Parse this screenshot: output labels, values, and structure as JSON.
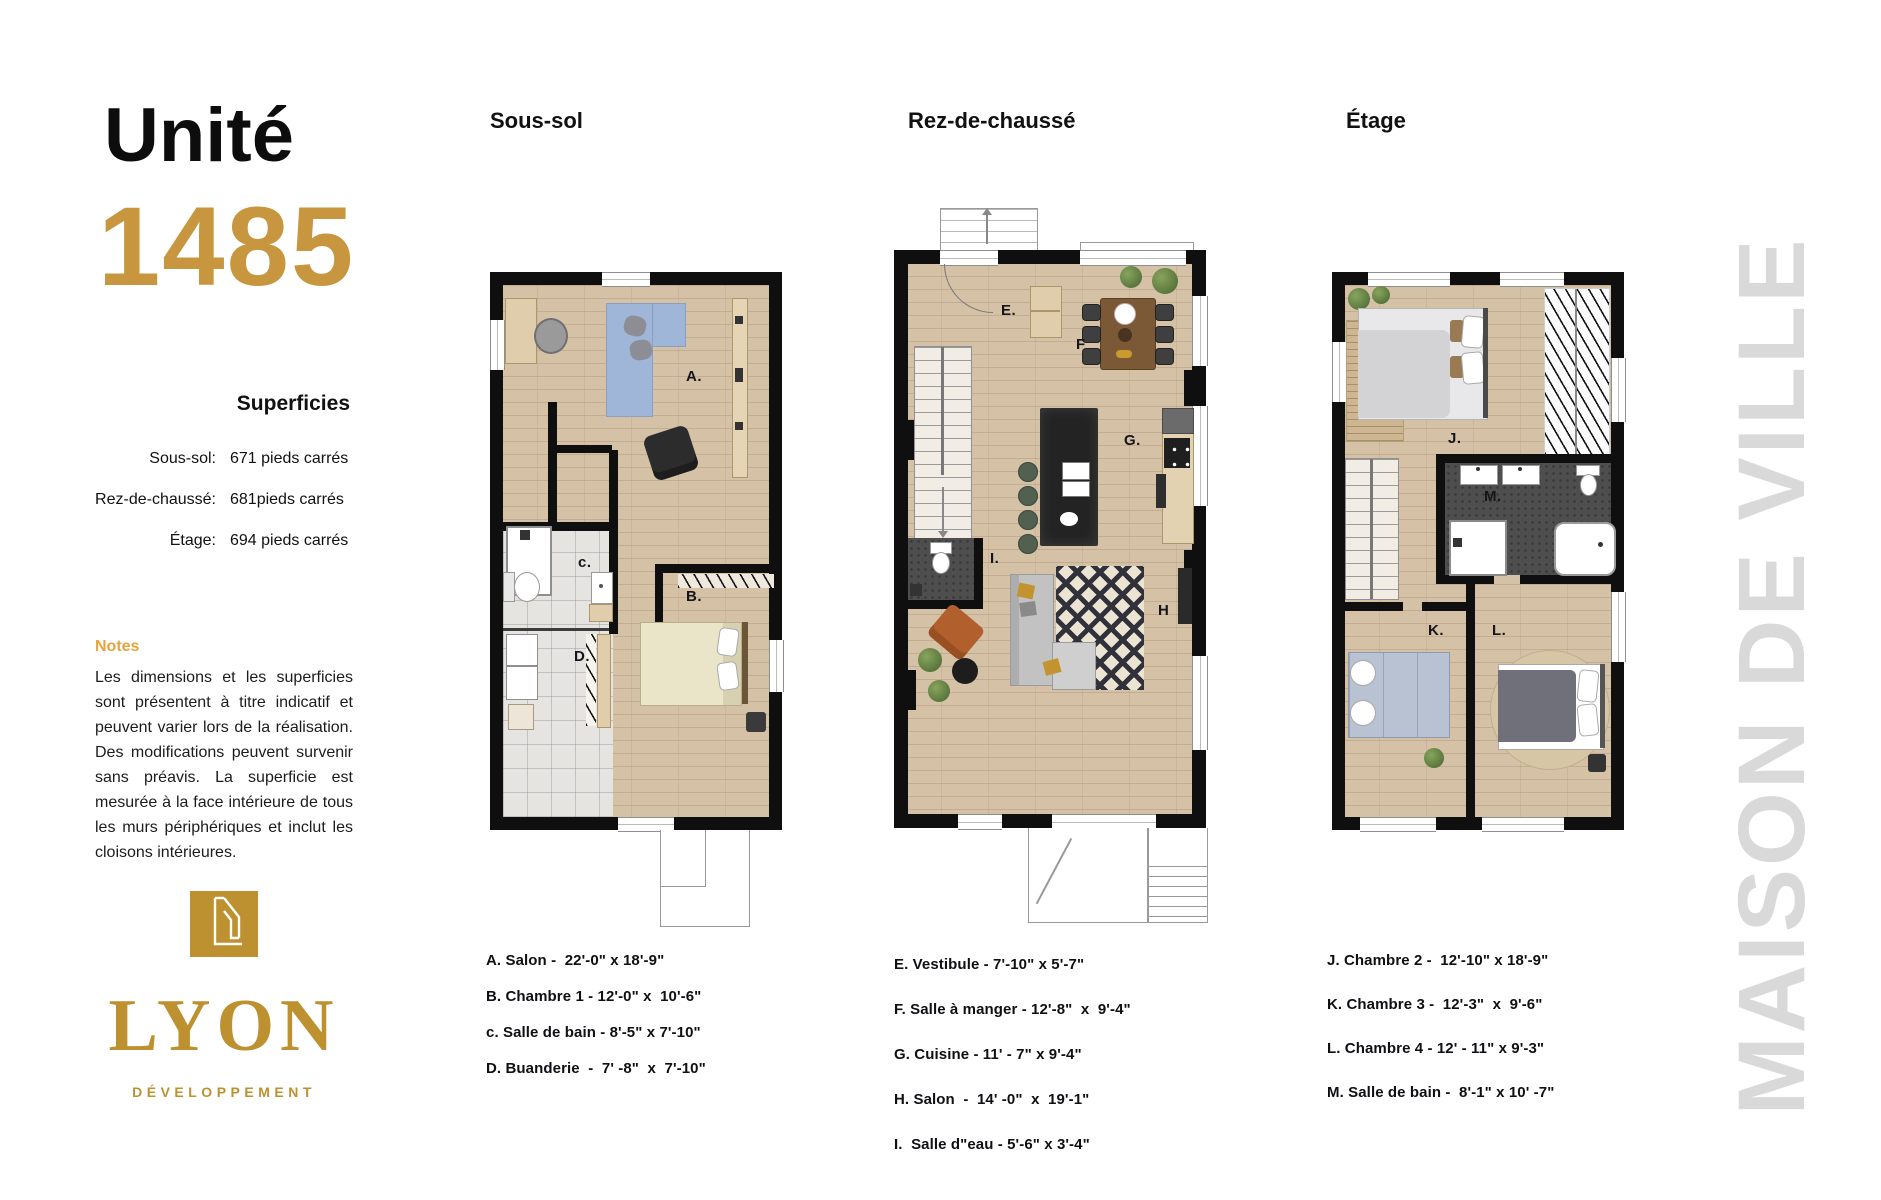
{
  "unit": {
    "title_label": "Unité",
    "number": "1485"
  },
  "superficies": {
    "title": "Superficies",
    "rows": [
      {
        "label": "Sous-sol:",
        "value": "671 pieds carrés"
      },
      {
        "label": "Rez-de-chaussé:",
        "value": "681pieds carrés"
      },
      {
        "label": "Étage:",
        "value": "694 pieds carrés"
      }
    ]
  },
  "notes": {
    "title": "Notes",
    "body": "Les dimensions et les superficies sont présentent à titre indicatif et peuvent varier lors de la réalisation. Des modifications peuvent survenir sans préavis. La superficie est mesurée à la face intérieure de tous les murs périphériques et inclut les cloisons intérieures."
  },
  "brand": {
    "name": "LYON",
    "subtitle": "DÉVELOPPEMENT"
  },
  "watermark": "MAISON DE VILLE",
  "plans": [
    {
      "title": "Sous-sol",
      "rooms": {
        "a": "A.",
        "b": "B.",
        "c": "c.",
        "d": "D."
      },
      "legend": [
        "A. Salon -  22'-0\" x 18'-9\"",
        "B. Chambre 1 - 12'-0\" x  10'-6\"",
        "c. Salle de bain - 8'-5\" x 7'-10\"",
        "D. Buanderie  -  7' -8\"  x  7'-10\""
      ]
    },
    {
      "title": "Rez-de-chaussé",
      "rooms": {
        "e": "E.",
        "f": "F",
        "g": "G.",
        "h": "H",
        "i": "I."
      },
      "legend": [
        "E. Vestibule - 7'-10\" x 5'-7\"",
        "F. Salle à manger - 12'-8\"  x  9'-4\"",
        "G. Cuisine - 11' - 7\" x 9'-4\"",
        "H. Salon  -  14' -0\"  x  19'-1\"",
        "I.  Salle d\"eau - 5'-6\" x 3'-4\""
      ]
    },
    {
      "title": "Étage",
      "rooms": {
        "j": "J.",
        "k": "K.",
        "l": "L.",
        "m": "M."
      },
      "legend": [
        "J. Chambre 2 -  12'-10\" x 18'-9\"",
        "K. Chambre 3 -  12'-3\"  x  9'-6\"",
        "L. Chambre 4 - 12' - 11\" x 9'-3\"",
        "M. Salle de bain -  8'-1\" x 10' -7\""
      ]
    }
  ],
  "colors": {
    "accent_gold": "#c8963e",
    "brand_gold": "#bd9130",
    "notes_gold": "#e8a33d",
    "watermark_gray": "#d9d9d9"
  }
}
